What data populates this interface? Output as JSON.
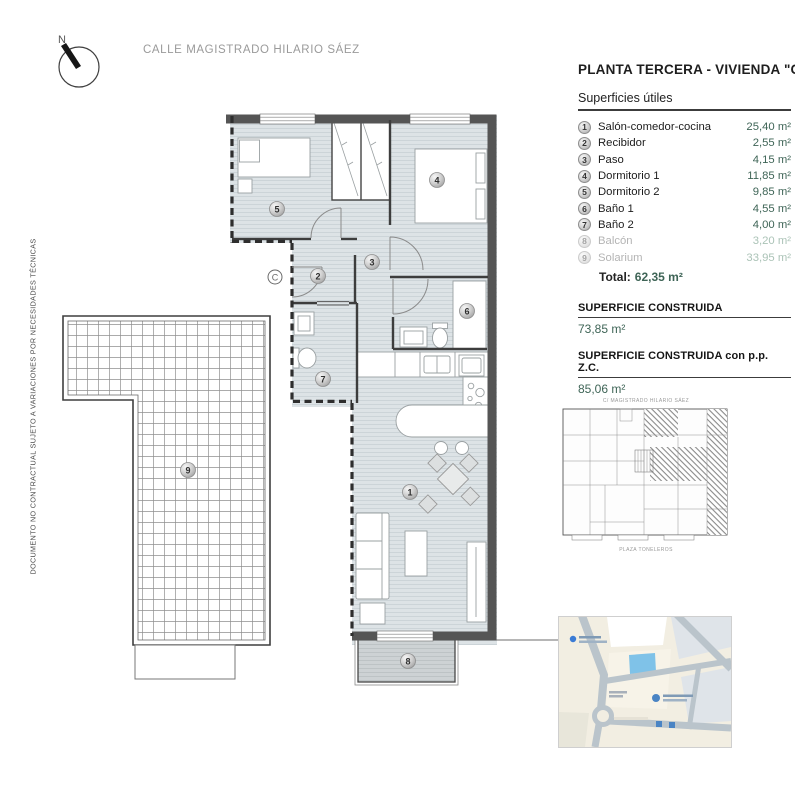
{
  "colors": {
    "accent_teal": "#3e6456",
    "muted_teal": "#abc3b7",
    "wall_gray": "#555555",
    "floor_fill": "#dde3e6",
    "map_building_blue": "#7fc2e8"
  },
  "header": {
    "compass_label": "N",
    "street_label": "CALLE MAGISTRADO HILARIO SÁEZ"
  },
  "side_note": {
    "disclaimer": "DOCUMENTO NO CONTRACTUAL SUJETO A VARIACIONES POR NECESIDADES TÉCNICAS"
  },
  "panel": {
    "title": "PLANTA TERCERA - VIVIENDA \"C\"",
    "surfaces_header": "Superficies útiles",
    "rooms": [
      {
        "num": "1",
        "label": "Salón-comedor-cocina",
        "area": "25,40 m²",
        "muted": false
      },
      {
        "num": "2",
        "label": "Recibidor",
        "area": "2,55 m²",
        "muted": false
      },
      {
        "num": "3",
        "label": "Paso",
        "area": "4,15 m²",
        "muted": false
      },
      {
        "num": "4",
        "label": "Dormitorio 1",
        "area": "11,85 m²",
        "muted": false
      },
      {
        "num": "5",
        "label": "Dormitorio 2",
        "area": "9,85 m²",
        "muted": false
      },
      {
        "num": "6",
        "label": "Baño 1",
        "area": "4,55 m²",
        "muted": false
      },
      {
        "num": "7",
        "label": "Baño 2",
        "area": "4,00 m²",
        "muted": false
      },
      {
        "num": "8",
        "label": "Balcón",
        "area": "3,20 m²",
        "muted": true
      },
      {
        "num": "9",
        "label": "Solarium",
        "area": "33,95 m²",
        "muted": true
      }
    ],
    "total_label": "Total:",
    "total_value": "62,35 m²",
    "built_areas": [
      {
        "label": "SUPERFICIE CONSTRUIDA",
        "value": "73,85 m²"
      },
      {
        "label": "SUPERFICIE CONSTRUIDA con p.p. Z.C.",
        "value": "85,06 m²"
      }
    ]
  },
  "floorplan": {
    "entrance_label": "C",
    "room_numbers": [
      "1",
      "2",
      "3",
      "4",
      "5",
      "6",
      "7",
      "8",
      "9"
    ]
  },
  "keyplan": {
    "top_label": "C/ MAGISTRADO HILARIO SÁEZ",
    "bottom_label": "PLAZA TONELEROS"
  }
}
